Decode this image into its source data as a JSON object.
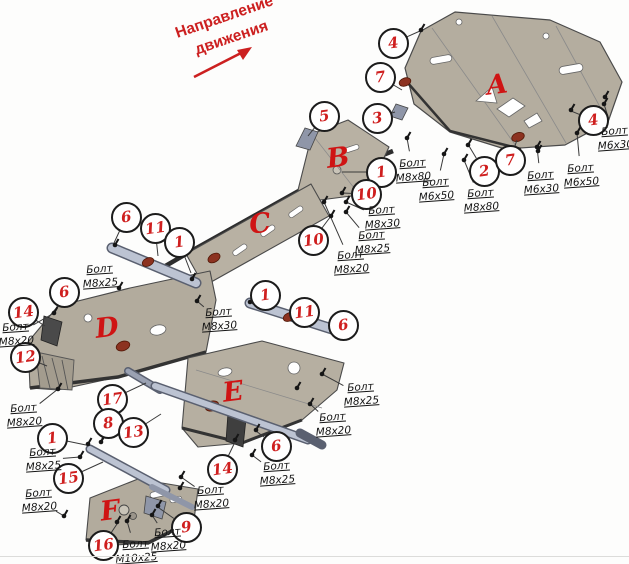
{
  "direction_arrow": {
    "line1": "Направление",
    "line2": "движения"
  },
  "colors": {
    "accent_red": "#cc2020",
    "plate_fill": "#b4ad9f",
    "strut_fill": "#bcc3d2",
    "bolt_head_red": "#8c3220",
    "line_color": "#3a3a3a"
  },
  "parts": [
    {
      "letter": "A",
      "x": 497,
      "y": 85
    },
    {
      "letter": "B",
      "x": 338,
      "y": 158
    },
    {
      "letter": "C",
      "x": 260,
      "y": 224
    },
    {
      "letter": "D",
      "x": 107,
      "y": 328
    },
    {
      "letter": "E",
      "x": 233,
      "y": 392
    },
    {
      "letter": "F",
      "x": 110,
      "y": 511
    }
  ],
  "callouts": [
    {
      "n": "4",
      "x": 393,
      "y": 43,
      "tx": 420,
      "ty": 31
    },
    {
      "n": "7",
      "x": 380,
      "y": 77,
      "tx": 402,
      "ty": 90
    },
    {
      "n": "3",
      "x": 377,
      "y": 118,
      "tx": 395,
      "ty": 112
    },
    {
      "n": "5",
      "x": 324,
      "y": 116,
      "tx": 308,
      "ty": 136
    },
    {
      "n": "1",
      "x": 381,
      "y": 172,
      "tx": 342,
      "ty": 172
    },
    {
      "n": "10",
      "x": 366,
      "y": 194,
      "tx": 342,
      "ty": 193
    },
    {
      "n": "10",
      "x": 313,
      "y": 240,
      "tx": 331,
      "ty": 216
    },
    {
      "n": "2",
      "x": 484,
      "y": 171,
      "tx": 469,
      "ty": 146
    },
    {
      "n": "7",
      "x": 510,
      "y": 160,
      "tx": 517,
      "ty": 140
    },
    {
      "n": "4",
      "x": 593,
      "y": 120,
      "tx": 571,
      "ty": 111
    },
    {
      "n": "6",
      "x": 126,
      "y": 217,
      "tx": 114,
      "ty": 243
    },
    {
      "n": "11",
      "x": 155,
      "y": 228,
      "tx": 158,
      "ty": 256
    },
    {
      "n": "1",
      "x": 179,
      "y": 242,
      "tx": 191,
      "ty": 273
    },
    {
      "n": "6",
      "x": 64,
      "y": 292,
      "tx": 56,
      "ty": 309
    },
    {
      "n": "14",
      "x": 23,
      "y": 312,
      "tx": 45,
      "ty": 326
    },
    {
      "n": "12",
      "x": 25,
      "y": 357,
      "tx": 47,
      "ty": 366
    },
    {
      "n": "1",
      "x": 265,
      "y": 295,
      "tx": 252,
      "ty": 304
    },
    {
      "n": "11",
      "x": 304,
      "y": 312,
      "tx": 296,
      "ty": 321
    },
    {
      "n": "6",
      "x": 343,
      "y": 325,
      "tx": 331,
      "ty": 328
    },
    {
      "n": "17",
      "x": 112,
      "y": 399,
      "tx": 146,
      "ty": 383
    },
    {
      "n": "8",
      "x": 108,
      "y": 423,
      "tx": 101,
      "ty": 441
    },
    {
      "n": "13",
      "x": 133,
      "y": 432,
      "tx": 161,
      "ty": 414
    },
    {
      "n": "1",
      "x": 52,
      "y": 438,
      "tx": 86,
      "ty": 445
    },
    {
      "n": "15",
      "x": 68,
      "y": 478,
      "tx": 103,
      "ty": 462
    },
    {
      "n": "16",
      "x": 103,
      "y": 545,
      "tx": 117,
      "ty": 524
    },
    {
      "n": "9",
      "x": 186,
      "y": 527,
      "tx": 159,
      "ty": 508
    },
    {
      "n": "6",
      "x": 276,
      "y": 446,
      "tx": 256,
      "ty": 431
    },
    {
      "n": "14",
      "x": 222,
      "y": 469,
      "tx": 235,
      "ty": 442
    }
  ],
  "bolt_labels": [
    {
      "line1": "Болт",
      "line2": "М6х30",
      "x": 615,
      "y": 139,
      "tx": 604,
      "ty": 104
    },
    {
      "line1": "Болт",
      "line2": "М6х50",
      "x": 581,
      "y": 176,
      "tx": 577,
      "ty": 133
    },
    {
      "line1": "Болт",
      "line2": "М6х30",
      "x": 541,
      "y": 183,
      "tx": 537,
      "ty": 147
    },
    {
      "line1": "Болт",
      "line2": "М8х80",
      "x": 481,
      "y": 201,
      "tx": 464,
      "ty": 160
    },
    {
      "line1": "Болт",
      "line2": "М6х50",
      "x": 436,
      "y": 190,
      "tx": 444,
      "ty": 154
    },
    {
      "line1": "Болт",
      "line2": "М8х80",
      "x": 413,
      "y": 171,
      "tx": 407,
      "ty": 138
    },
    {
      "line1": "Болт",
      "line2": "М8х30",
      "x": 382,
      "y": 218,
      "tx": 346,
      "ty": 202
    },
    {
      "line1": "Болт",
      "line2": "М8х25",
      "x": 372,
      "y": 243,
      "tx": 346,
      "ty": 212
    },
    {
      "line1": "Болт",
      "line2": "М8х20",
      "x": 351,
      "y": 263,
      "tx": 324,
      "ty": 202
    },
    {
      "line1": "Болт",
      "line2": "М8х30",
      "x": 219,
      "y": 320,
      "tx": 197,
      "ty": 301
    },
    {
      "line1": "Болт",
      "line2": "М8х25",
      "x": 100,
      "y": 277,
      "tx": 119,
      "ty": 288
    },
    {
      "line1": "Болт",
      "line2": "М8х20",
      "x": 16,
      "y": 335,
      "tx": 54,
      "ty": 313
    },
    {
      "line1": "Болт",
      "line2": "М8х20",
      "x": 24,
      "y": 416,
      "tx": 58,
      "ty": 389
    },
    {
      "line1": "Болт",
      "line2": "М8х25",
      "x": 43,
      "y": 460,
      "tx": 80,
      "ty": 457
    },
    {
      "line1": "Болт",
      "line2": "М8х20",
      "x": 39,
      "y": 501,
      "tx": 64,
      "ty": 516
    },
    {
      "line1": "Болт",
      "line2": "М10х25",
      "x": 136,
      "y": 552,
      "tx": 127,
      "ty": 521
    },
    {
      "line1": "Болт",
      "line2": "М8х20",
      "x": 168,
      "y": 540,
      "tx": 152,
      "ty": 515
    },
    {
      "line1": "Болт",
      "line2": "М8х20",
      "x": 211,
      "y": 498,
      "tx": 181,
      "ty": 477
    },
    {
      "line1": "Болт",
      "line2": "М8х25",
      "x": 277,
      "y": 474,
      "tx": 252,
      "ty": 455
    },
    {
      "line1": "Болт",
      "line2": "М8х20",
      "x": 333,
      "y": 425,
      "tx": 310,
      "ty": 404
    },
    {
      "line1": "Болт",
      "line2": "М8х25",
      "x": 361,
      "y": 395,
      "tx": 322,
      "ty": 374
    }
  ],
  "extra_bolts": [
    [
      421,
      30
    ],
    [
      571,
      110
    ],
    [
      605,
      97
    ],
    [
      468,
      145
    ],
    [
      538,
      151
    ],
    [
      60,
      300
    ],
    [
      115,
      245
    ],
    [
      192,
      279
    ],
    [
      250,
      302
    ],
    [
      331,
      327
    ],
    [
      88,
      444
    ],
    [
      101,
      442
    ],
    [
      235,
      440
    ],
    [
      256,
      430
    ],
    [
      158,
      506
    ],
    [
      117,
      522
    ],
    [
      342,
      193
    ],
    [
      331,
      216
    ],
    [
      297,
      388
    ],
    [
      180,
      488
    ]
  ]
}
